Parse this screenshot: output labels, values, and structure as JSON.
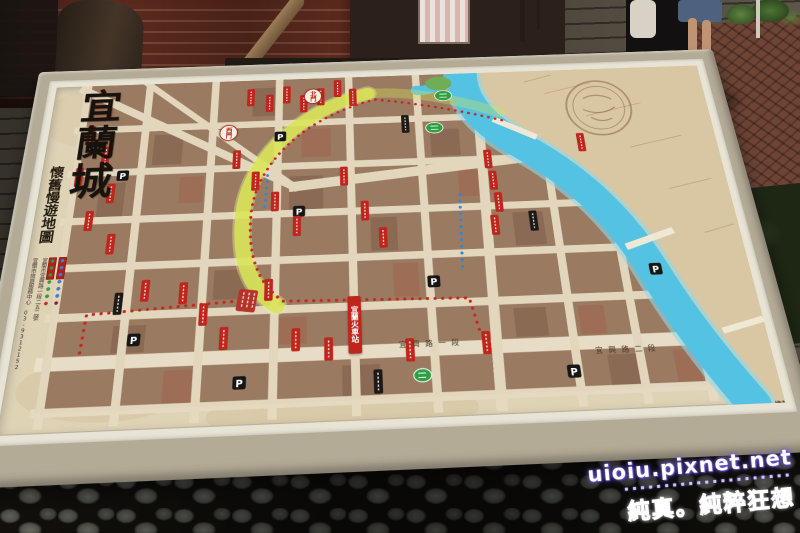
{
  "colors": {
    "board_frame": "#b4ab96",
    "map_parchment": "#dfd3b6",
    "river": "#54c2e2",
    "old_wall_route": "#d8e455",
    "marker_red": "#c0251c",
    "marker_green": "#2f9e44",
    "marker_blue": "#2f86d6",
    "watermark_purple": "#5b4bc8"
  },
  "map": {
    "title": "宜蘭城",
    "subtitle": "懷舊慢遊地圖",
    "gates": {
      "west": "西門",
      "north": "北門"
    },
    "station_label": "宜蘭火車站",
    "parking_label": "P",
    "streets": {
      "station_road_1": "宜興路一段",
      "station_road_2": "宜興路二段"
    },
    "legend": {
      "contact": "宜蘭市旅遊服務中心 03-9312152",
      "address": "宜蘭市宜興路一段二五二號"
    },
    "credits": {
      "organizer": "主辦單位:宜蘭縣政府",
      "co_organizer": "協辦單位:宜蘭縣宜蘭市鄂王社區發展協會",
      "cartographer": "編繪:光大巷工作室"
    }
  },
  "watermark": {
    "site": "uioiu.pixnet.net",
    "dots": "▪▪▪▪▪▪▪▪▪▪▪▪▪▪▪▪▪▪▪▪▪",
    "slogan": "純真。純粹狂想"
  }
}
